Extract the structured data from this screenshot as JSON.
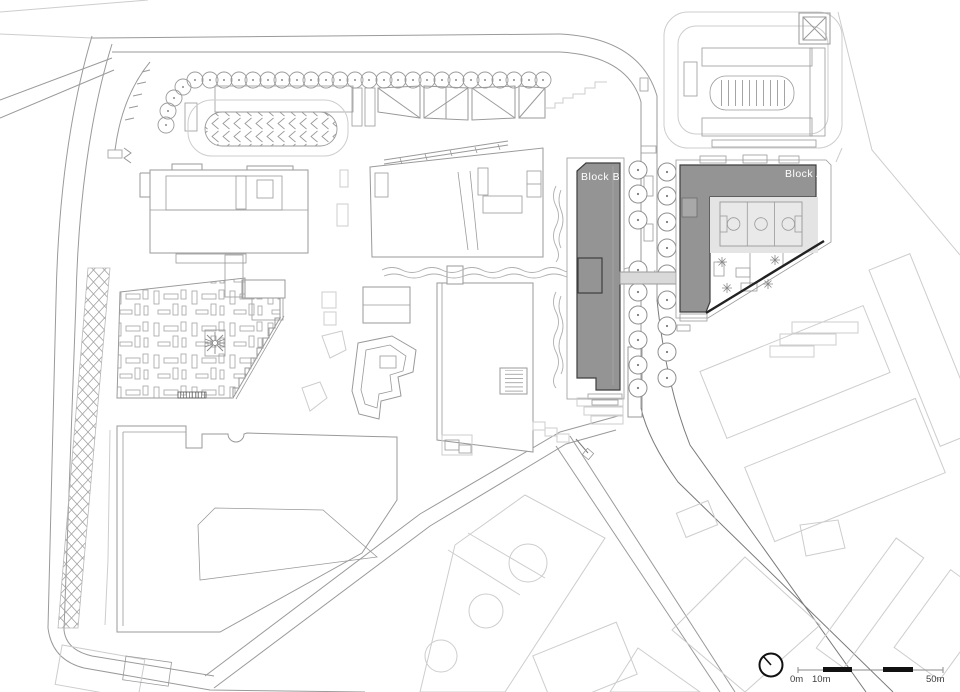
{
  "labels": {
    "block_a": "Block A",
    "block_b": "Block B"
  },
  "scale_bar": {
    "zero": "0m",
    "ten": "10m",
    "fifty": "50m"
  },
  "icons": [
    "north-arrow-icon",
    "scale-bar",
    "basketball-court",
    "crossed-square-ramp"
  ],
  "colors": {
    "background": "#ffffff",
    "line": "#9a9a9a",
    "context_line": "#cdcdcd",
    "block_fill": "#949494",
    "block_outline": "#3e3e3e",
    "court_fill": "#e4e4e4",
    "bridge_fill": "#d9d9d9",
    "label_text": "#ffffff",
    "scale_black": "#111111"
  }
}
